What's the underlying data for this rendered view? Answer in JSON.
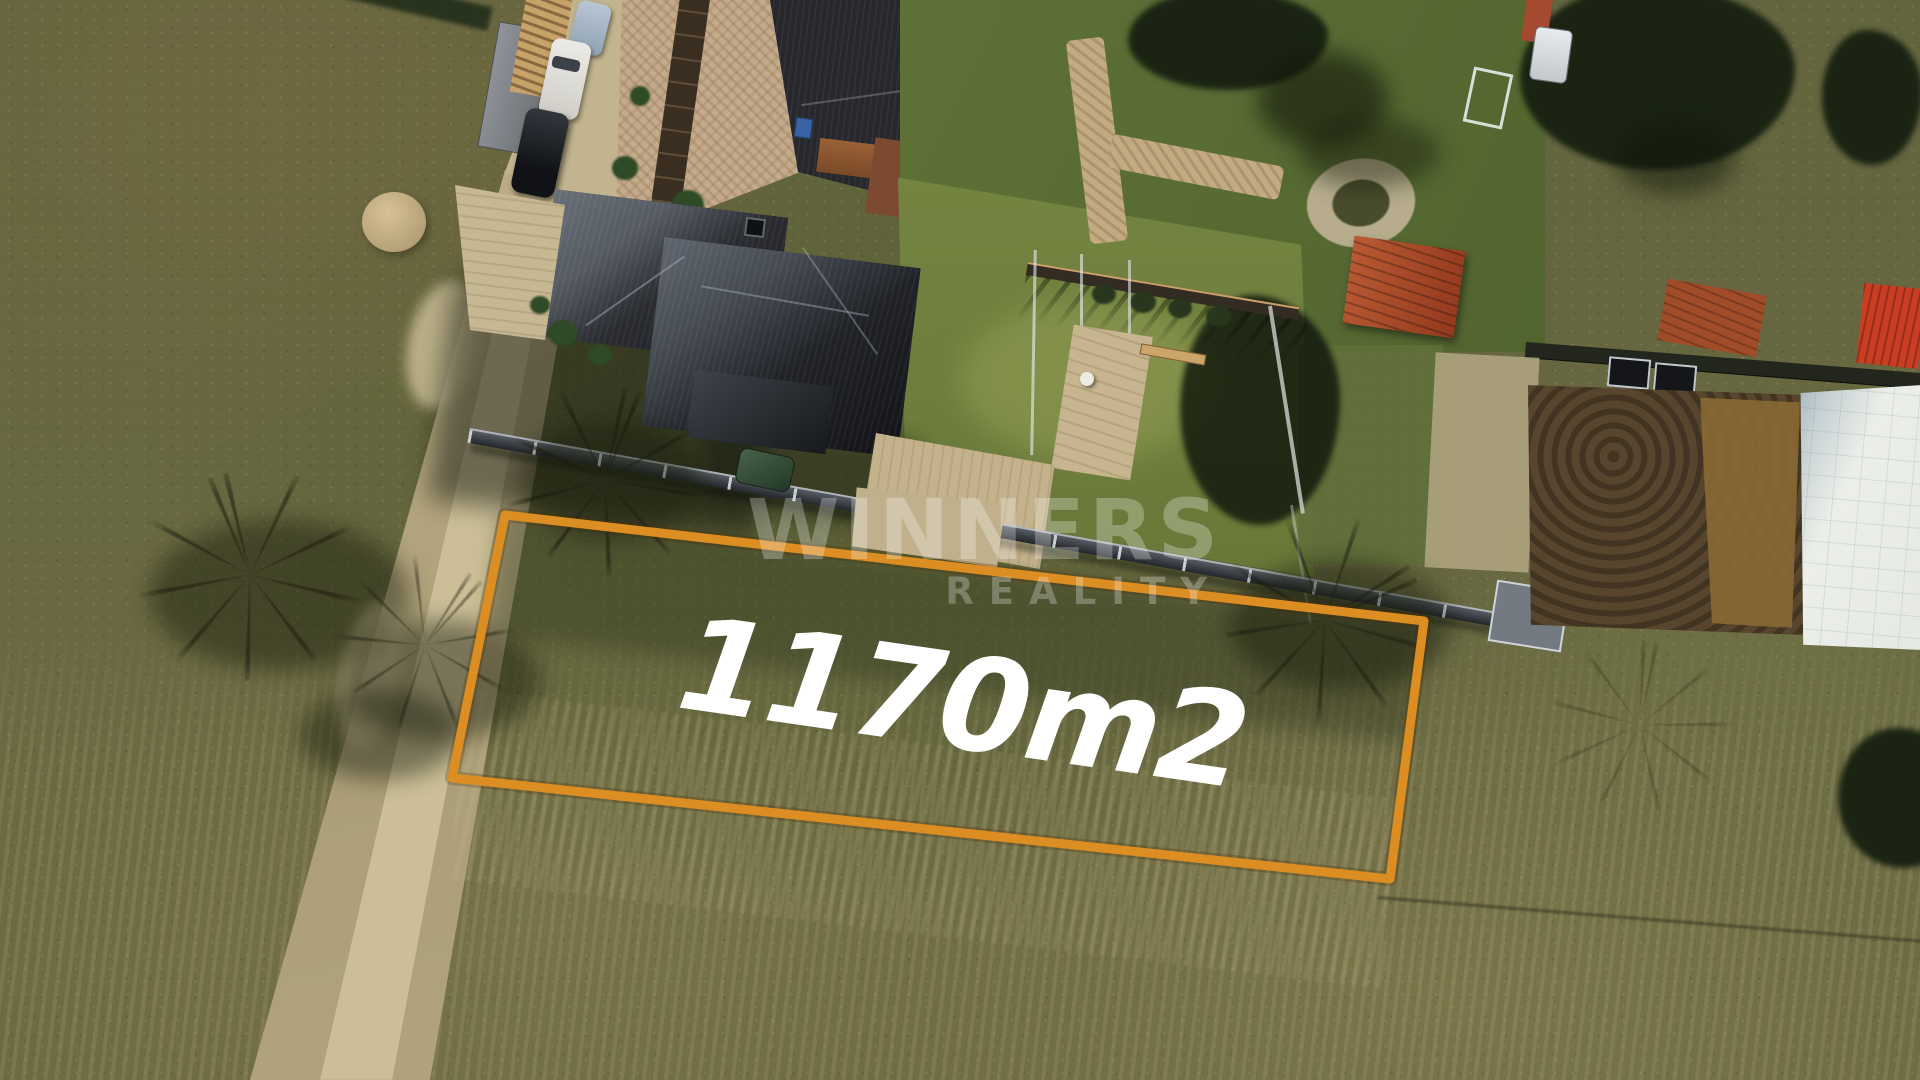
{
  "overlay": {
    "area_label": "1170m2",
    "watermark": {
      "line1": "WINNERS",
      "line2": "REALITY"
    }
  },
  "plot": {
    "outline_points": "505,515 1424,621 1390,879 452,778",
    "outline_color": "#dd8e22"
  },
  "colors": {
    "outline_orange": "#dd8e22",
    "label_white": "#ffffff",
    "watermark_white": "rgba(255,255,255,0.27)",
    "field_olive": "#6b6a43",
    "dirt_path_tan": "#b9ab83",
    "road_beige": "#c4b790",
    "roof_dark": "#26282d",
    "roof_lit": "#5e646d",
    "lawn_green": "#6f7f40",
    "red_shed_roof": "#b0502f",
    "bright_red_roof": "#c93d22",
    "concrete_slab": "#e9ece8",
    "excavation_brown": "#57452e"
  }
}
